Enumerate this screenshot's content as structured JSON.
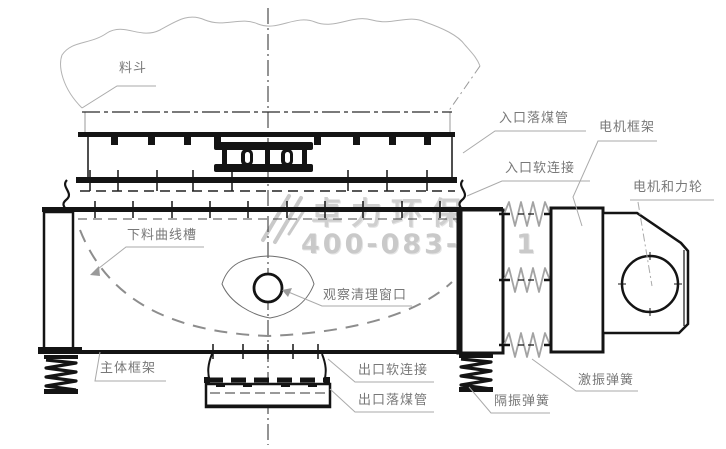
{
  "drawing": {
    "labels": {
      "hopper": "料斗",
      "inlet_coal_pipe": "入口落煤管",
      "inlet_soft_connection": "入口软连接",
      "motor_frame": "电机框架",
      "motor_force_wheel": "电机和力轮",
      "discharge_curve_chute": "下料曲线槽",
      "inspection_window": "观察清理窗口",
      "main_body_frame": "主体框架",
      "outlet_soft_connection": "出口软连接",
      "outlet_coal_pipe": "出口落煤管",
      "isolation_spring": "隔振弹簧",
      "excitation_spring": "激振弹簧"
    },
    "watermark": {
      "brand": "卓力环保",
      "phone": "400-083-45 1"
    },
    "colors": {
      "line": "#141414",
      "leader": "#a8a8a8",
      "label_text": "#787878",
      "watermark": "#cfcfcf",
      "background": "#ffffff"
    }
  }
}
